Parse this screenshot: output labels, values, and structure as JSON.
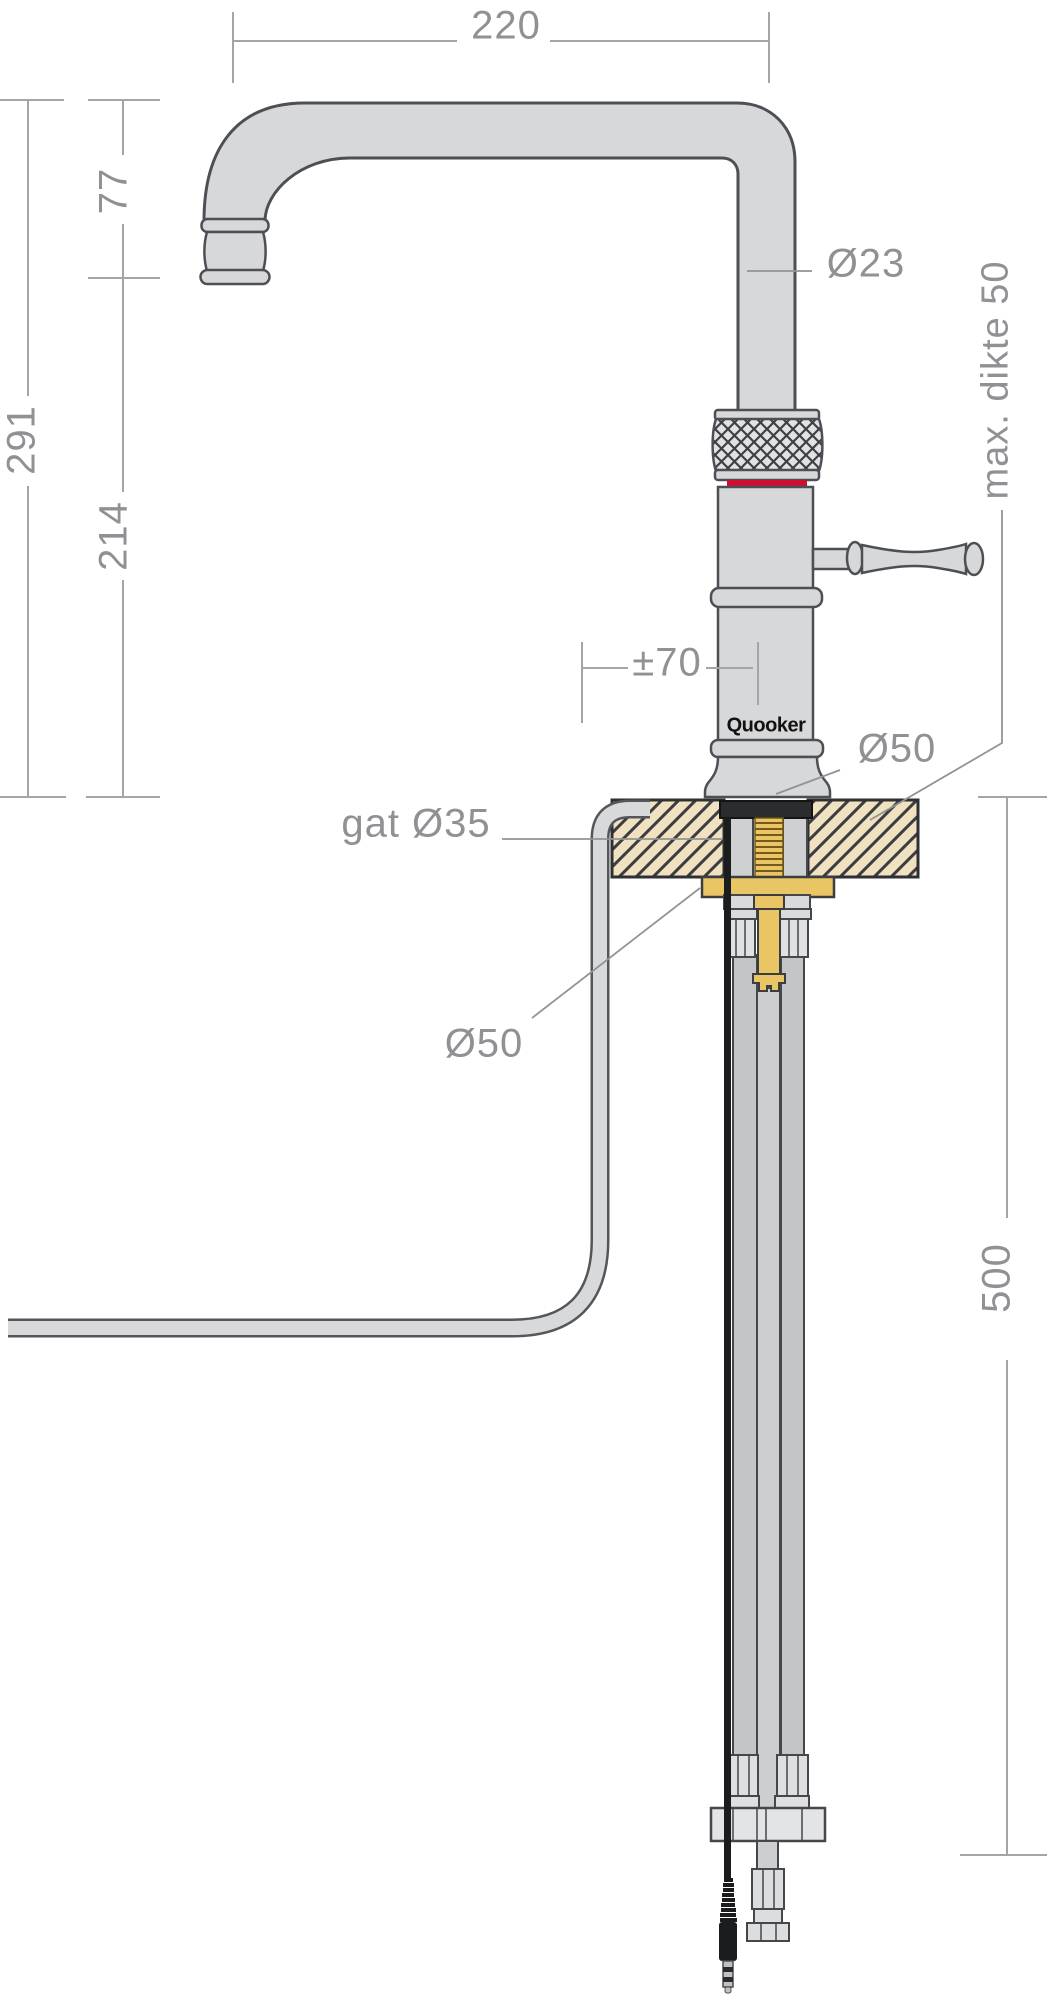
{
  "drawing": {
    "title": "Quooker tap installation dimension drawing",
    "logo": "Quooker",
    "labels": {
      "spout_reach": "220",
      "spout_clearance": "77",
      "total_height": "291",
      "body_height": "214",
      "spout_diameter": "Ø23",
      "max_worktop_thickness": "max. dikte 50",
      "handle_clearance": "±70",
      "base_diameter": "Ø50",
      "hole_label": "gat Ø35",
      "flange_diameter": "Ø50",
      "below_worktop_clearance": "500"
    },
    "colors": {
      "metal_fill": "#d7d8d9",
      "outline": "#4e4f54",
      "dimension_text": "#8f9194",
      "dimension_line": "#a4a5a7",
      "red_ring": "#cc0f32",
      "brass": "#eac566",
      "worktop": "#f0e2c1",
      "cable_black": "#1b1c1e"
    }
  }
}
